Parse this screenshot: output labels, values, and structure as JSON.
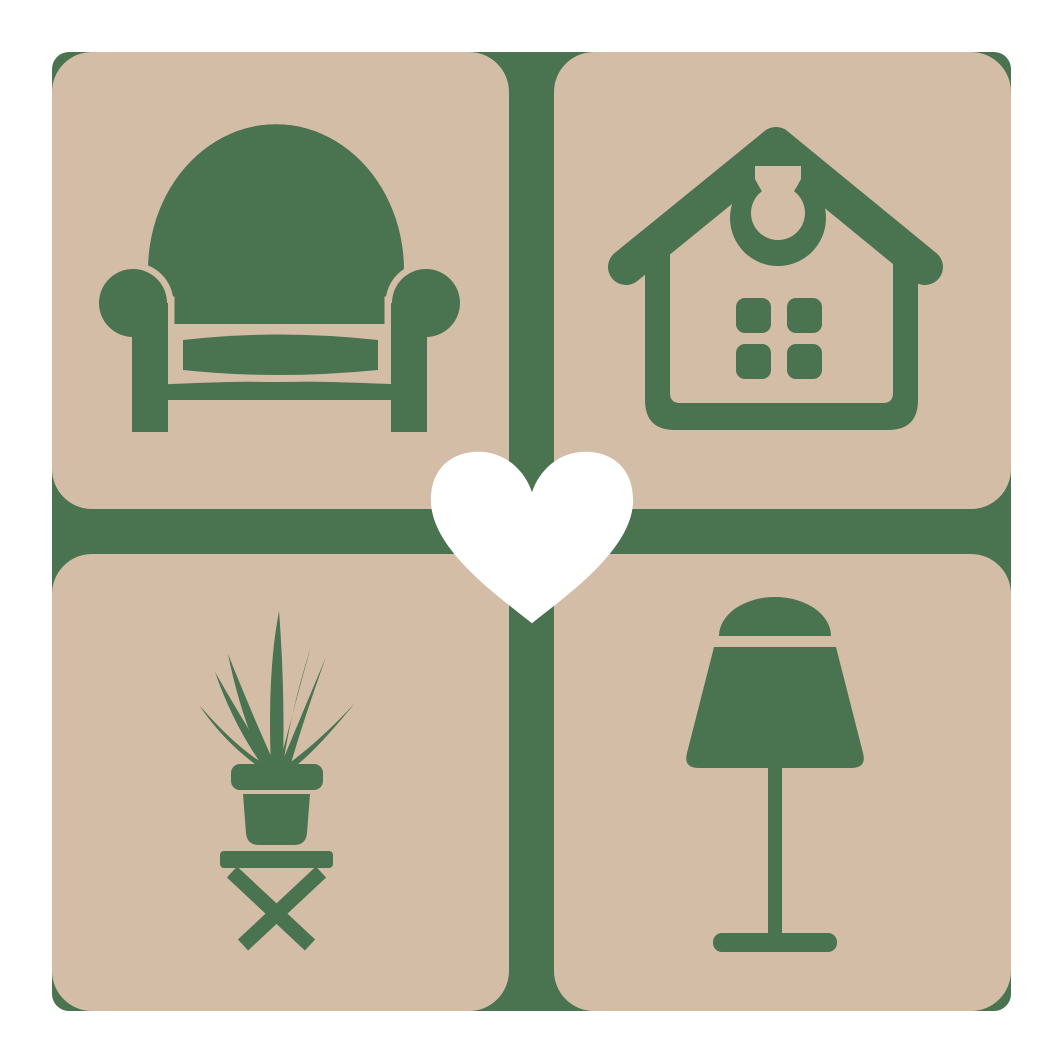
{
  "logo": {
    "description": "Home and furniture logo: four beige rounded tiles on a green backdrop forming a cross, with green armchair, house, potted plant and table lamp icons, and a white heart in the center",
    "colors": {
      "page-bg": "#ffffff",
      "green": "#4a7350",
      "beige": "#d4bda7",
      "heart": "#ffffff"
    },
    "tiles": [
      {
        "icon": "armchair-icon",
        "position": "top-left"
      },
      {
        "icon": "house-icon",
        "position": "top-right"
      },
      {
        "icon": "potted-plant-icon",
        "position": "bottom-left"
      },
      {
        "icon": "table-lamp-icon",
        "position": "bottom-right"
      }
    ],
    "center_icon": "heart-icon"
  }
}
